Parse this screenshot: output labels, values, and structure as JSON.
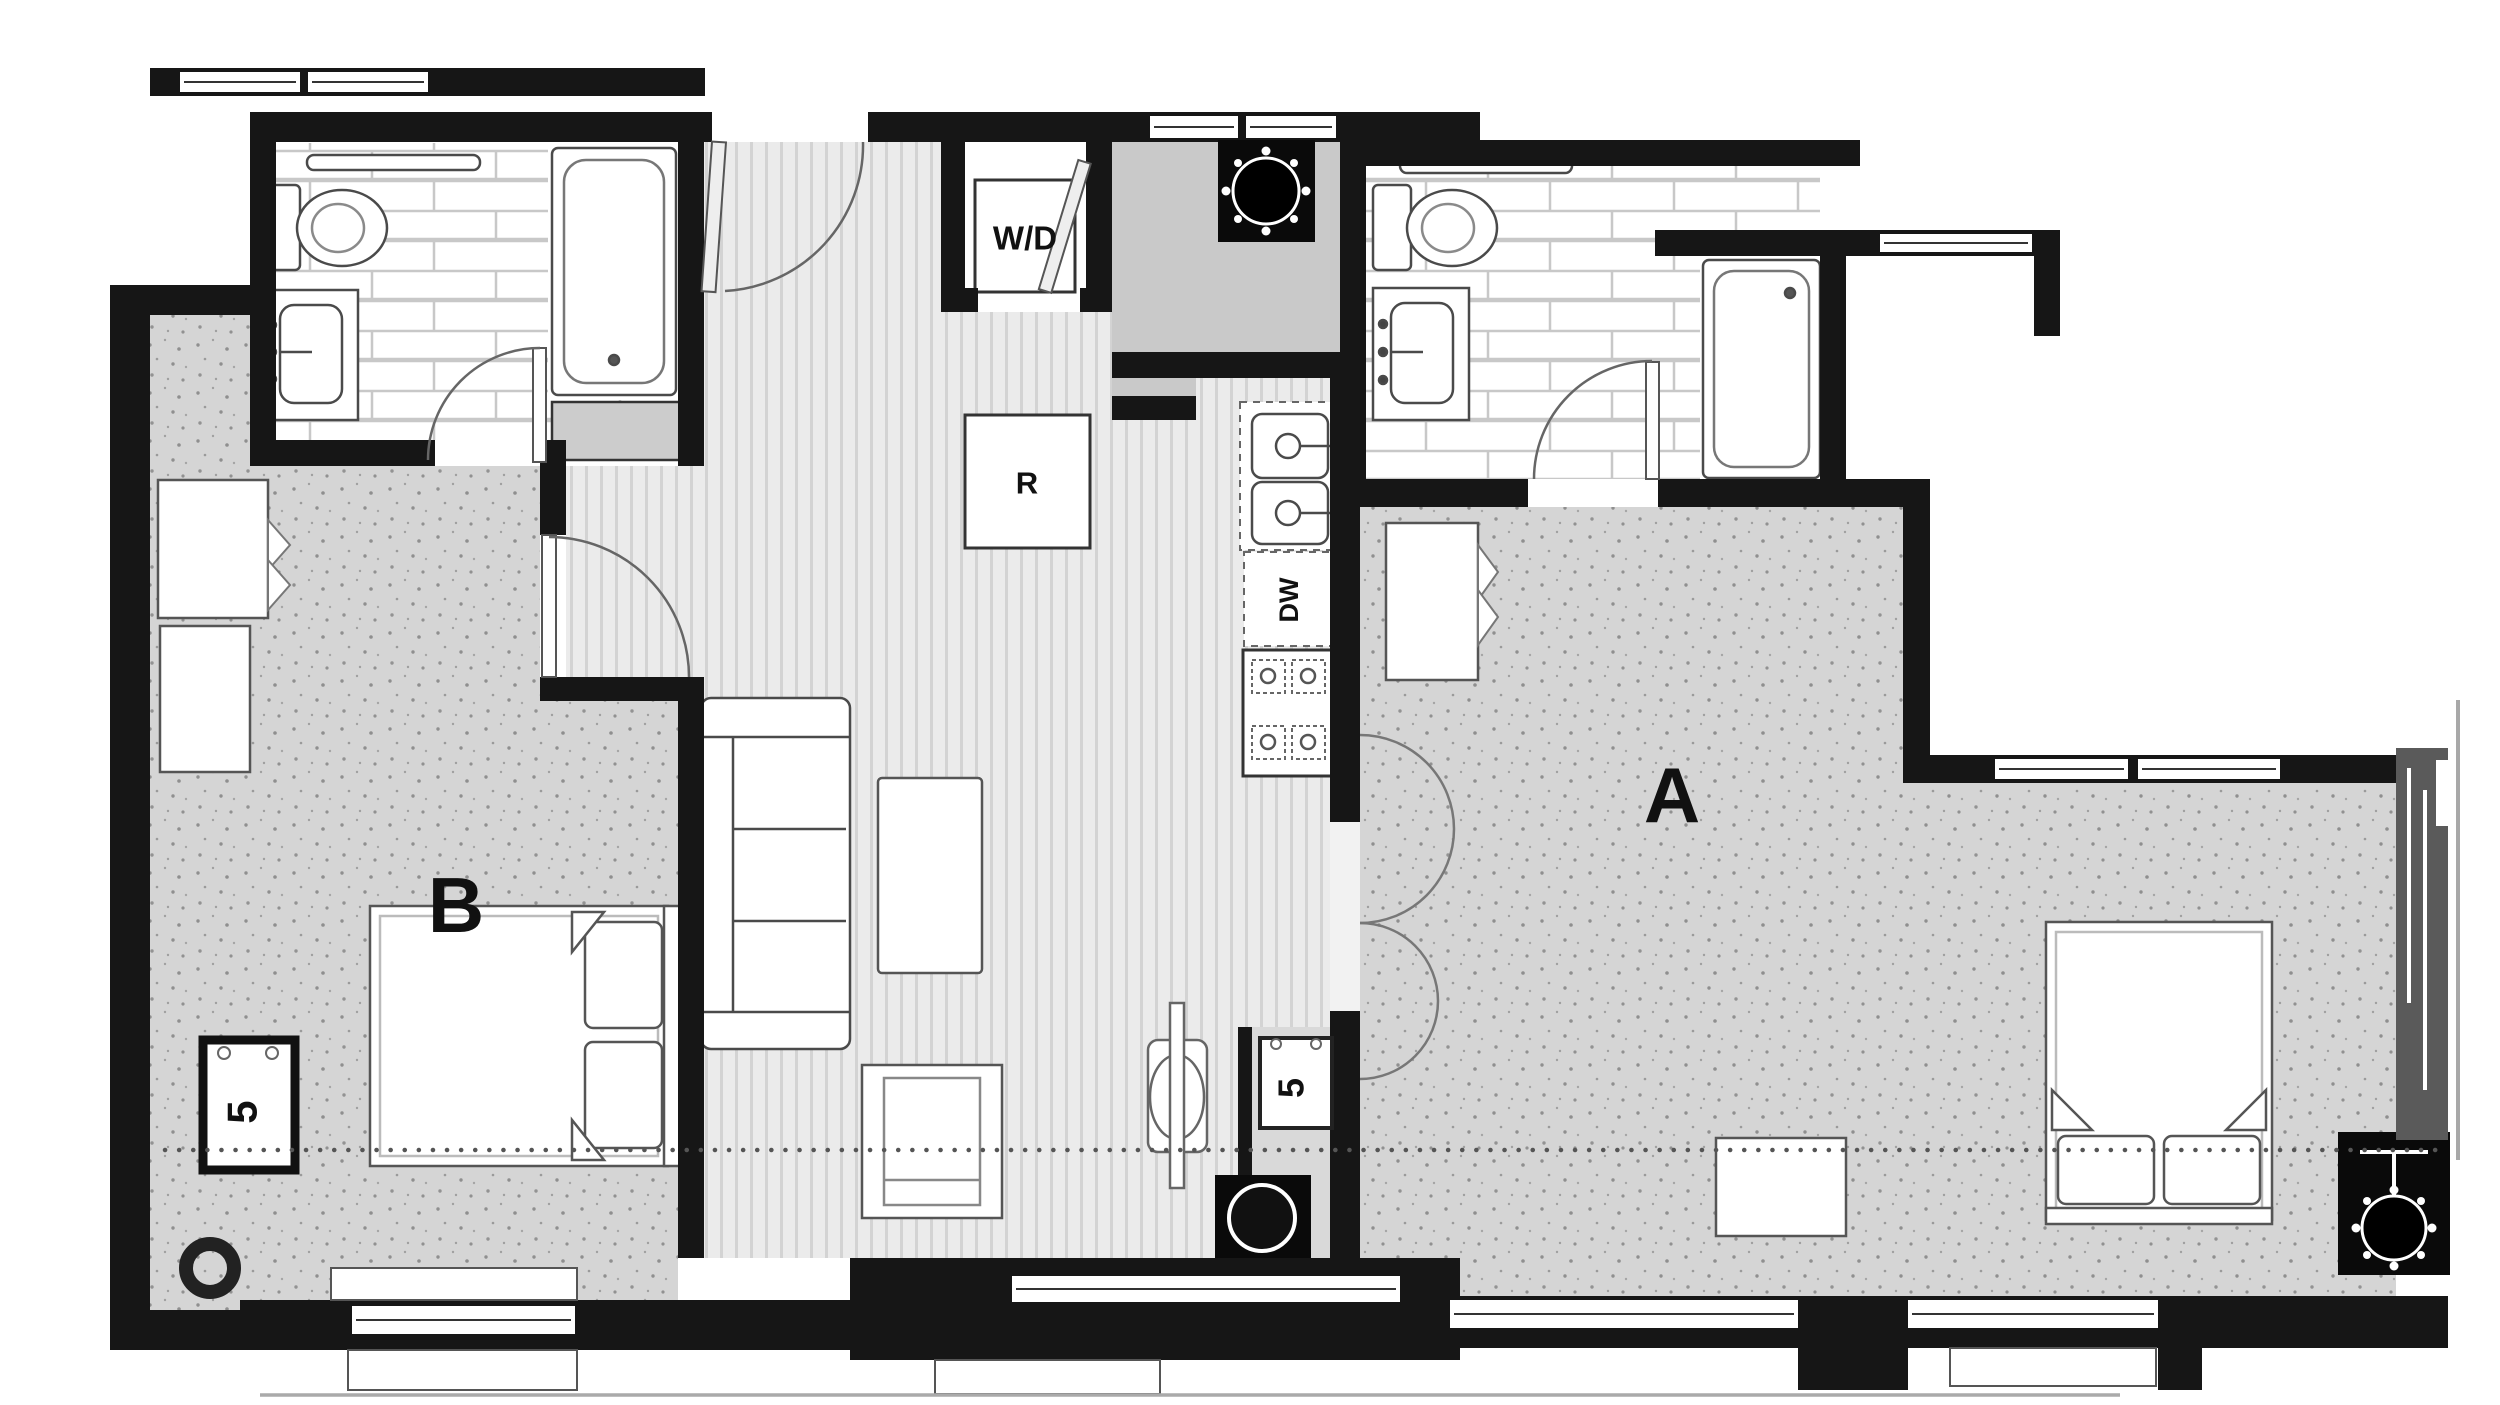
{
  "floor_plan": {
    "type": "apartment-floor-plan",
    "unit_labels": {
      "a": "A",
      "b": "B"
    },
    "appliance_labels": {
      "washer_dryer": "W/D",
      "refrigerator": "R",
      "dishwasher": "DW"
    },
    "keynote_labels": {
      "unit_b": "5",
      "unit_a": "5"
    },
    "colors": {
      "wall": "#161616",
      "bedroom_floor": "#d5d5d5",
      "hall_floor": "#ebebeb",
      "bathroom_floor": "#ffffff",
      "tile_line": "#c8c8c8",
      "chase_fill": "#c9c9c9",
      "alcove_fill": "#d9d9d9",
      "glazing_band": "#5a5a5a",
      "furniture_line": "#4a4a4a",
      "label_text": "#111111"
    }
  }
}
